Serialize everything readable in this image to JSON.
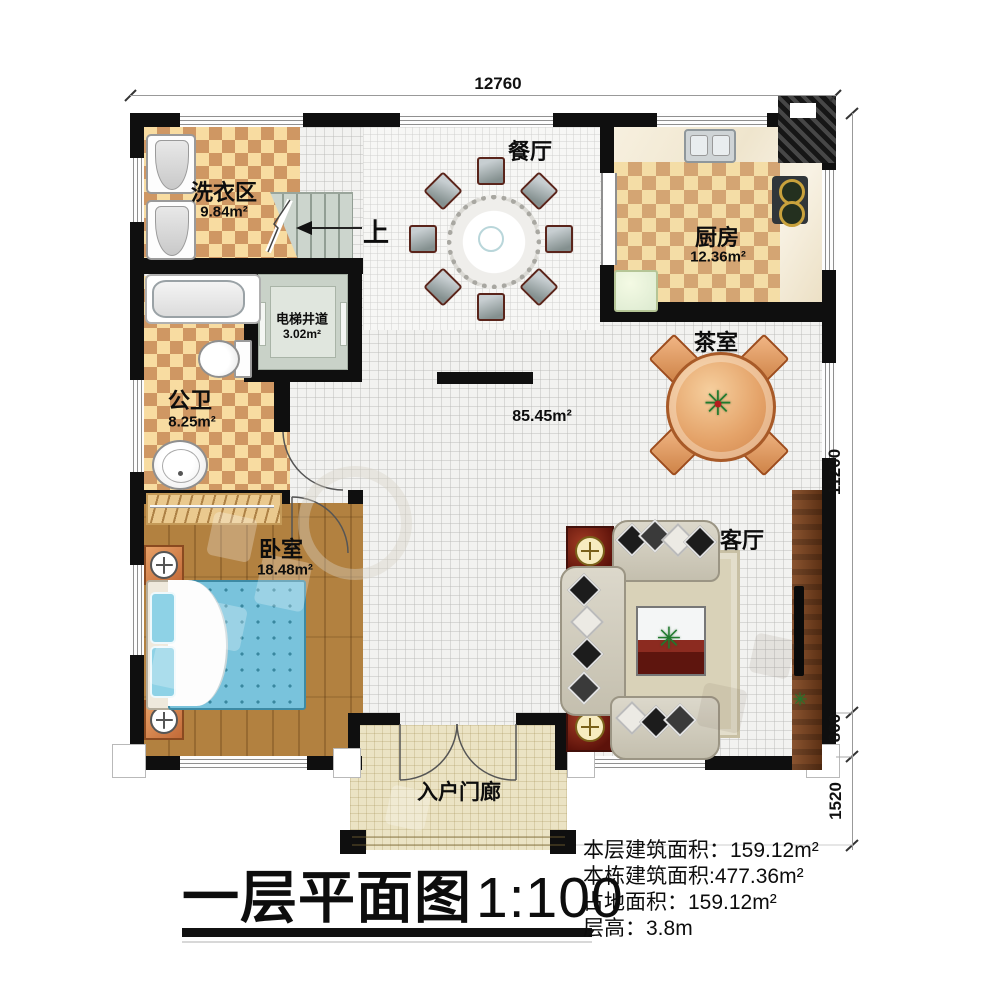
{
  "footer": {
    "title": "一层平面图",
    "scale": "1:100",
    "stats": [
      {
        "label": "本层建筑面积：",
        "value": "159.12m²"
      },
      {
        "label": "本栋建筑面积:",
        "value": "477.36m²"
      },
      {
        "label": "占地面积：",
        "value": "159.12m²"
      },
      {
        "label": "层高：",
        "value": "3.8m"
      }
    ]
  },
  "dimensions": {
    "top_width": "12760",
    "right_height": "11200",
    "right_lower": "800",
    "right_porch": "1520"
  },
  "rooms": {
    "laundry": {
      "name": "洗衣区",
      "area": "9.84m²"
    },
    "dining": {
      "name": "餐厅"
    },
    "kitchen": {
      "name": "厨房",
      "area": "12.36m²"
    },
    "elevator": {
      "name": "电梯井道",
      "area": "3.02m²"
    },
    "bathroom": {
      "name": "公卫",
      "area": "8.25m²"
    },
    "tea_room": {
      "name": "茶室"
    },
    "hall": {
      "area": "85.45m²"
    },
    "bedroom": {
      "name": "卧室",
      "area": "18.48m²"
    },
    "living": {
      "name": "客厅"
    },
    "porch": {
      "name": "入户门廊"
    },
    "stairs": {
      "direction": "上"
    }
  },
  "plants": {
    "glyph": "✳"
  },
  "colors": {
    "wall": "#0f0f0f",
    "tile_light": "#f8dca1",
    "tile_dark": "#cf9763",
    "wood_floor": "#b28140",
    "bed_blue": "#79c3dc",
    "sofa_beige": "#d6d1c0",
    "tea_table_wood": "#e4a268",
    "red_wood": "#8c2b20"
  }
}
